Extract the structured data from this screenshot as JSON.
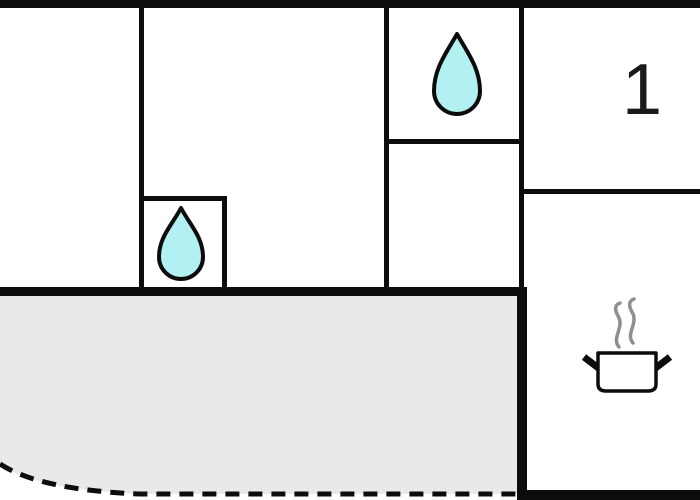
{
  "colors": {
    "background": "#ffffff",
    "wall": "#0d0d0d",
    "terrace_fill": "#e9e9e9",
    "drop_fill": "#b3f0f2",
    "drop_outline": "#0c0c0c",
    "pot_outline": "#0c0c0c",
    "pot_fill": "#ffffff",
    "steam": "#8f8f8f",
    "label_color": "#1a1a1a"
  },
  "rooms": {
    "room1": {
      "label": "1"
    },
    "bathroom_upper": {
      "icon": "water-drop-icon"
    },
    "bathroom_lower": {
      "icon": "water-drop-icon"
    },
    "kitchen": {
      "icon": "cooking-pot-steam-icon"
    },
    "terrace": {
      "icon": "dashed-boundary"
    }
  }
}
